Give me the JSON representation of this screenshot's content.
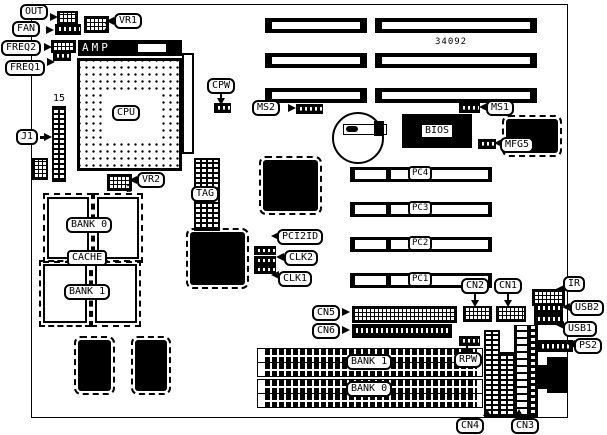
{
  "diagram": {
    "type": "motherboard-layout",
    "board_number": "34092",
    "labels": {
      "out": "OUT",
      "fan": "FAN",
      "freq2": "FREQ2",
      "freq1": "FREQ1",
      "vr1": "VR1",
      "vr1_pin": "2",
      "amp": "AMP",
      "cpu": "CPU",
      "j1": "J1",
      "j1_pin": "15",
      "vr2": "VR2",
      "vr2_pin": "2",
      "cpw": "CPW",
      "ms2": "MS2",
      "ms1": "MS1",
      "bios": "BIOS",
      "mfg5": "MFG5",
      "tag": "TAG",
      "cache_bank0": "BANK 0",
      "cache": "CACHE",
      "cache_bank1": "BANK 1",
      "pci2id": "PCI2ID",
      "clk2": "CLK2",
      "clk1": "CLK1",
      "pc4": "PC4",
      "pc3": "PC3",
      "pc2": "PC2",
      "pc1": "PC1",
      "cn2": "CN2",
      "cn1": "CN1",
      "ir": "IR",
      "usb2": "USB2",
      "usb1": "USB1",
      "ps2": "PS2",
      "cn5": "CN5",
      "cn6": "CN6",
      "simm_bank1": "BANK 1",
      "simm_bank0": "BANK 0",
      "rpw": "RPW",
      "cn4": "CN4",
      "cn3": "CN3"
    }
  }
}
